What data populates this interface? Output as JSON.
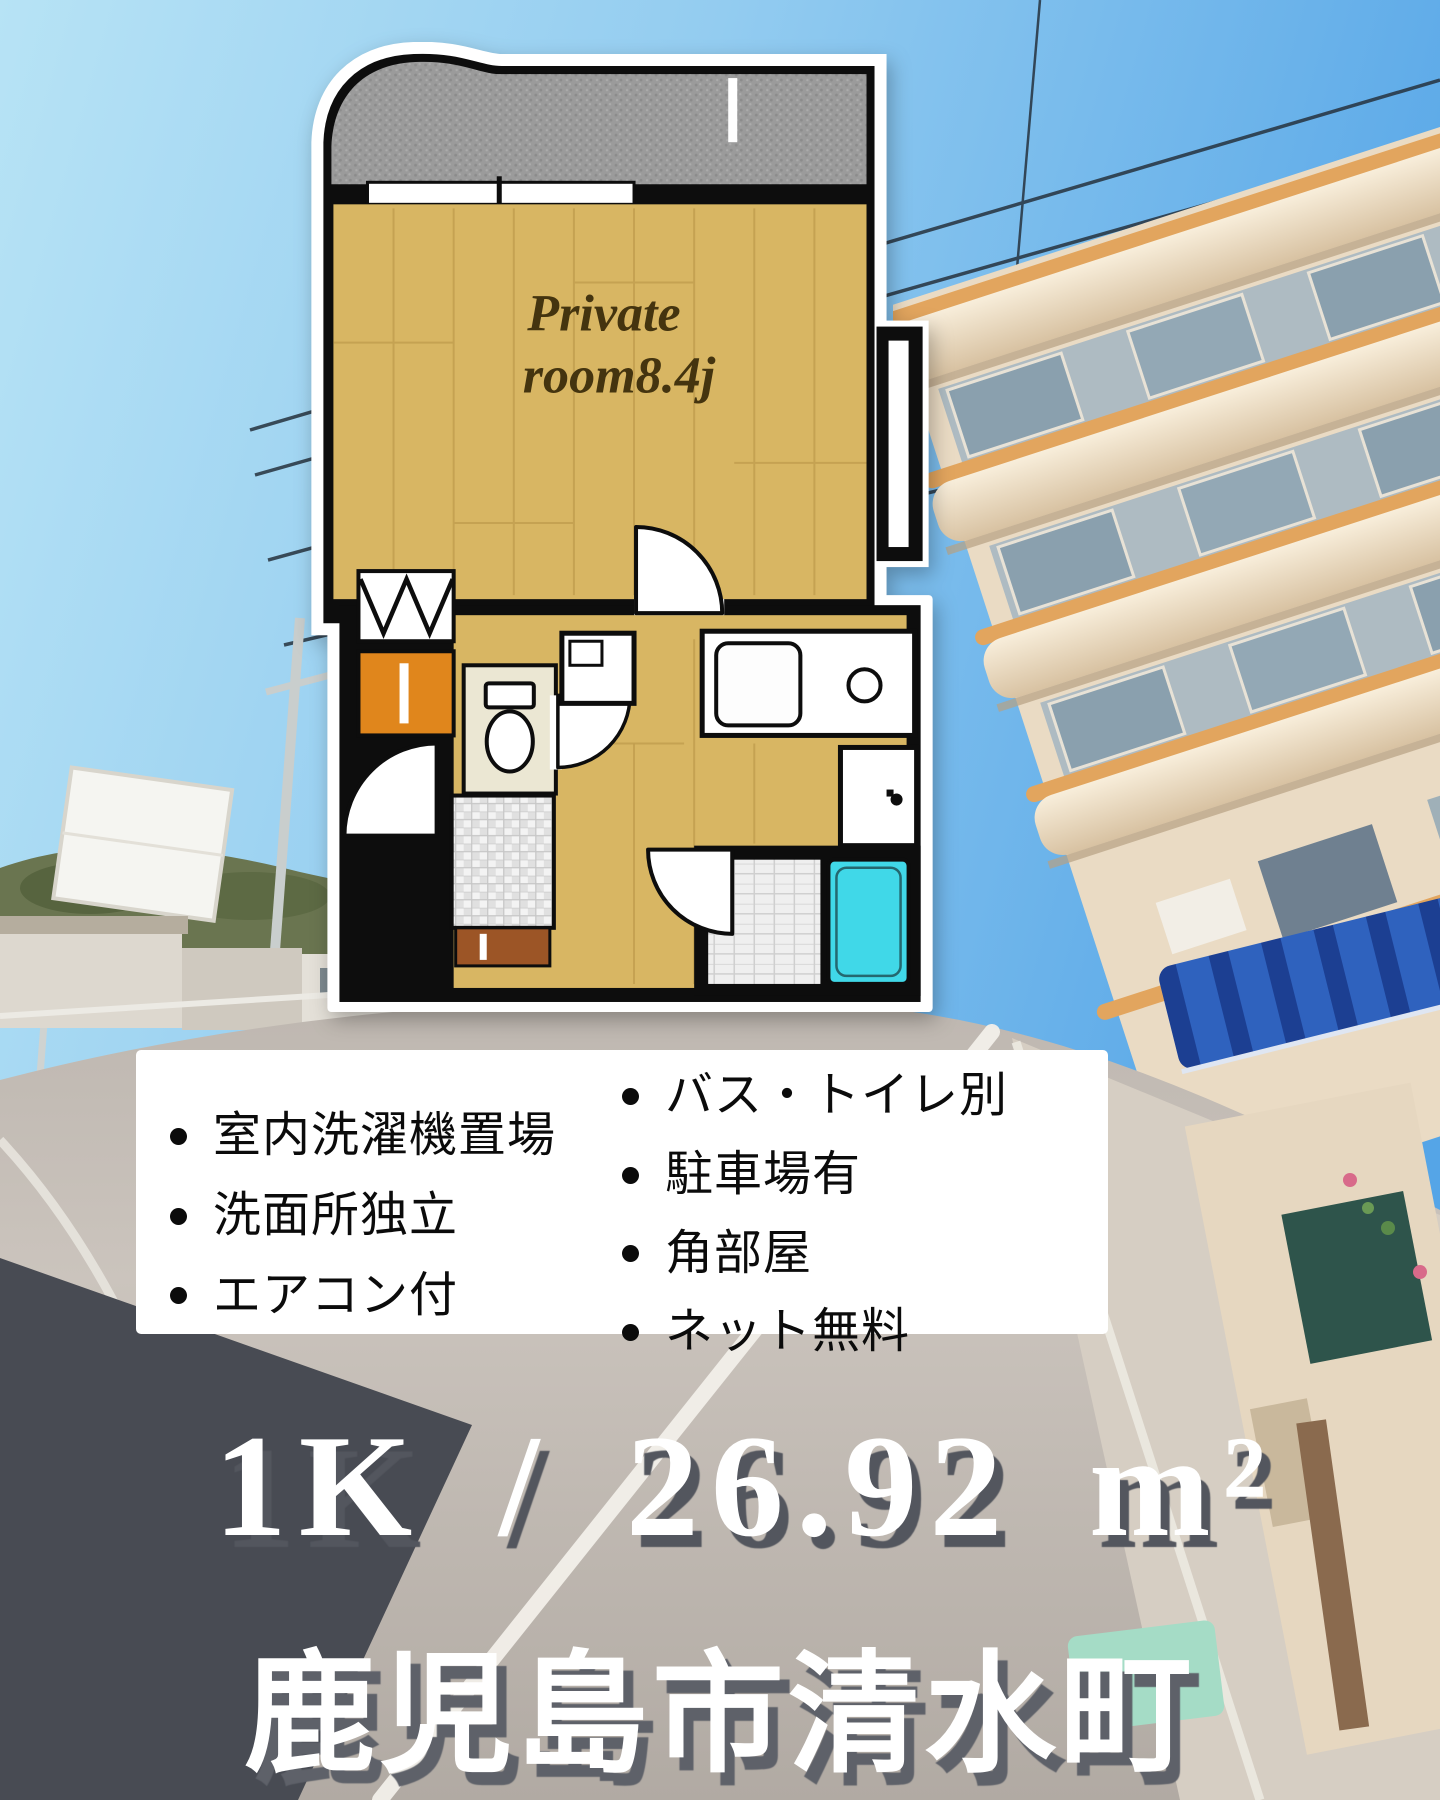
{
  "listing": {
    "spec_line": "1K / 26.92 m²",
    "location_line": "鹿児島市清水町"
  },
  "features": {
    "left_column": [
      "室内洗濯機置場",
      "洗面所独立",
      "エアコン付"
    ],
    "right_column": [
      "バス・トイレ別",
      "駐車場有",
      "角部屋",
      "ネット無料"
    ]
  },
  "floor_plan": {
    "room_label_line1": "Private",
    "room_label_line2": "room8.4j",
    "colors": {
      "wood_floor": "#d8b663",
      "balcony_gray": "#9b9b9b",
      "porch_orange": "#e0861c",
      "entrance_brown": "#9c5526",
      "bathtub_cyan": "#40d8e8",
      "toilet_room_cream": "#ebe7d3",
      "wall_black": "#0d0d0d"
    }
  },
  "photo": {
    "sky_blue": "#58a8e8",
    "building_cream": "#eadbc4",
    "building_trim_orange": "#e2a55e",
    "road_gray": "#b6afa8",
    "awning_blue": "#2f62be",
    "shadow_slate": "#484b53"
  }
}
